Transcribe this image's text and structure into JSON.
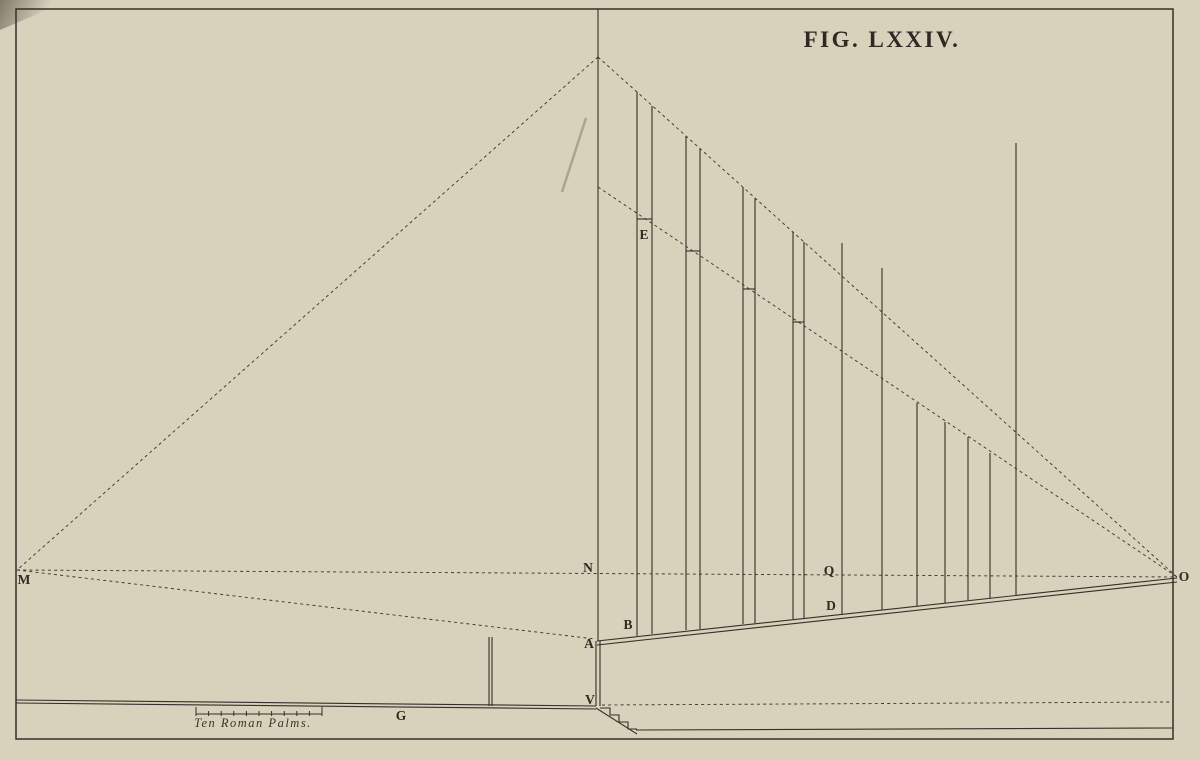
{
  "title": "FIG. LXXIV.",
  "colors": {
    "paper": "#d8d1bb",
    "ink": "#34302a",
    "dash": "#403a30",
    "letter": "#2e2a23"
  },
  "scale_bar": {
    "label": "Ten Roman Palms.",
    "x1": 196,
    "x2": 322,
    "y": 714,
    "divisions": 10,
    "end_tick_height": 9,
    "mid_tick_height": 5
  },
  "figure_labels": [
    {
      "text": "M",
      "x": 24,
      "y": 584
    },
    {
      "text": "N",
      "x": 588,
      "y": 572
    },
    {
      "text": "O",
      "x": 1184,
      "y": 581
    },
    {
      "text": "Q",
      "x": 829,
      "y": 575
    },
    {
      "text": "B",
      "x": 628,
      "y": 629
    },
    {
      "text": "A",
      "x": 589,
      "y": 648
    },
    {
      "text": "D",
      "x": 831,
      "y": 610
    },
    {
      "text": "V",
      "x": 590,
      "y": 704
    },
    {
      "text": "E",
      "x": 644,
      "y": 239
    },
    {
      "text": "G",
      "x": 401,
      "y": 720
    }
  ],
  "lines": {
    "dashed": [
      {
        "name": "ray-apex-to-m",
        "x1": 598,
        "y1": 57,
        "x2": 17,
        "y2": 570
      },
      {
        "name": "ray-apex-to-o",
        "x1": 598,
        "y1": 57,
        "x2": 1177,
        "y2": 577
      },
      {
        "name": "ray-e-to-o",
        "x1": 598,
        "y1": 187,
        "x2": 1177,
        "y2": 577
      },
      {
        "name": "horizon-m-to-o",
        "x1": 17,
        "y1": 570,
        "x2": 1177,
        "y2": 577
      },
      {
        "name": "ray-m-to-a",
        "x1": 17,
        "y1": 570,
        "x2": 595,
        "y2": 639
      },
      {
        "name": "pavement-dashed-right",
        "x1": 602,
        "y1": 705,
        "x2": 1170,
        "y2": 702
      }
    ],
    "solid": [
      {
        "name": "center-vertical",
        "x1": 598,
        "y1": 9,
        "x2": 598,
        "y2": 641
      },
      {
        "name": "center-vertical-left-edge",
        "x1": 596,
        "y1": 641,
        "x2": 596,
        "y2": 706
      },
      {
        "name": "center-vertical-right-edge",
        "x1": 600,
        "y1": 641,
        "x2": 600,
        "y2": 706
      },
      {
        "name": "inclined-ground-upper",
        "x1": 597,
        "y1": 641,
        "x2": 1177,
        "y2": 578
      },
      {
        "name": "inclined-ground-lower",
        "x1": 597,
        "y1": 645,
        "x2": 1177,
        "y2": 582
      },
      {
        "name": "pavement-left-upper",
        "x1": 16,
        "y1": 700,
        "x2": 596,
        "y2": 706
      },
      {
        "name": "pavement-left-lower",
        "x1": 16,
        "y1": 703,
        "x2": 596,
        "y2": 709
      },
      {
        "name": "post-left-edge",
        "x1": 489,
        "y1": 637,
        "x2": 489,
        "y2": 706
      },
      {
        "name": "post-right-edge",
        "x1": 492,
        "y1": 637,
        "x2": 492,
        "y2": 706
      },
      {
        "name": "steps-diagonal",
        "x1": 596,
        "y1": 708,
        "x2": 637,
        "y2": 734
      },
      {
        "name": "lower-pavement-right",
        "x1": 636,
        "y1": 730,
        "x2": 1173,
        "y2": 728
      }
    ],
    "smudges": [
      {
        "name": "scan-smudge",
        "x1": 586,
        "y1": 118,
        "x2": 562,
        "y2": 192
      }
    ]
  },
  "paths": [
    {
      "name": "steps-outline",
      "d": "M 600 708 L 610 708 L 610 715 L 619 715 L 619 722 L 628 722 L 628 729 L 637 729"
    }
  ],
  "columns": {
    "pairs": [
      {
        "left": 637,
        "right": 652,
        "top_left": 92,
        "top_right": 106,
        "tick_y": 219,
        "bottom_left": 636,
        "bottom_right": 634
      },
      {
        "left": 686,
        "right": 700,
        "top_left": 136,
        "top_right": 149,
        "tick_y": 251,
        "bottom_left": 630,
        "bottom_right": 629
      },
      {
        "left": 743,
        "right": 755,
        "top_left": 187,
        "top_right": 198,
        "tick_y": 289,
        "bottom_left": 624,
        "bottom_right": 623
      },
      {
        "left": 793,
        "right": 804,
        "top_left": 232,
        "top_right": 242,
        "tick_y": 322,
        "bottom_left": 619,
        "bottom_right": 618
      }
    ],
    "singles": [
      {
        "x": 842,
        "top": 243,
        "bottom": 614
      },
      {
        "x": 882,
        "top": 268,
        "bottom": 610
      },
      {
        "x": 917,
        "top": 403,
        "bottom": 606
      },
      {
        "x": 945,
        "top": 422,
        "bottom": 603
      },
      {
        "x": 968,
        "top": 437,
        "bottom": 600
      },
      {
        "x": 990,
        "top": 453,
        "bottom": 598
      },
      {
        "x": 1016,
        "top": 143,
        "bottom": 595
      }
    ]
  }
}
